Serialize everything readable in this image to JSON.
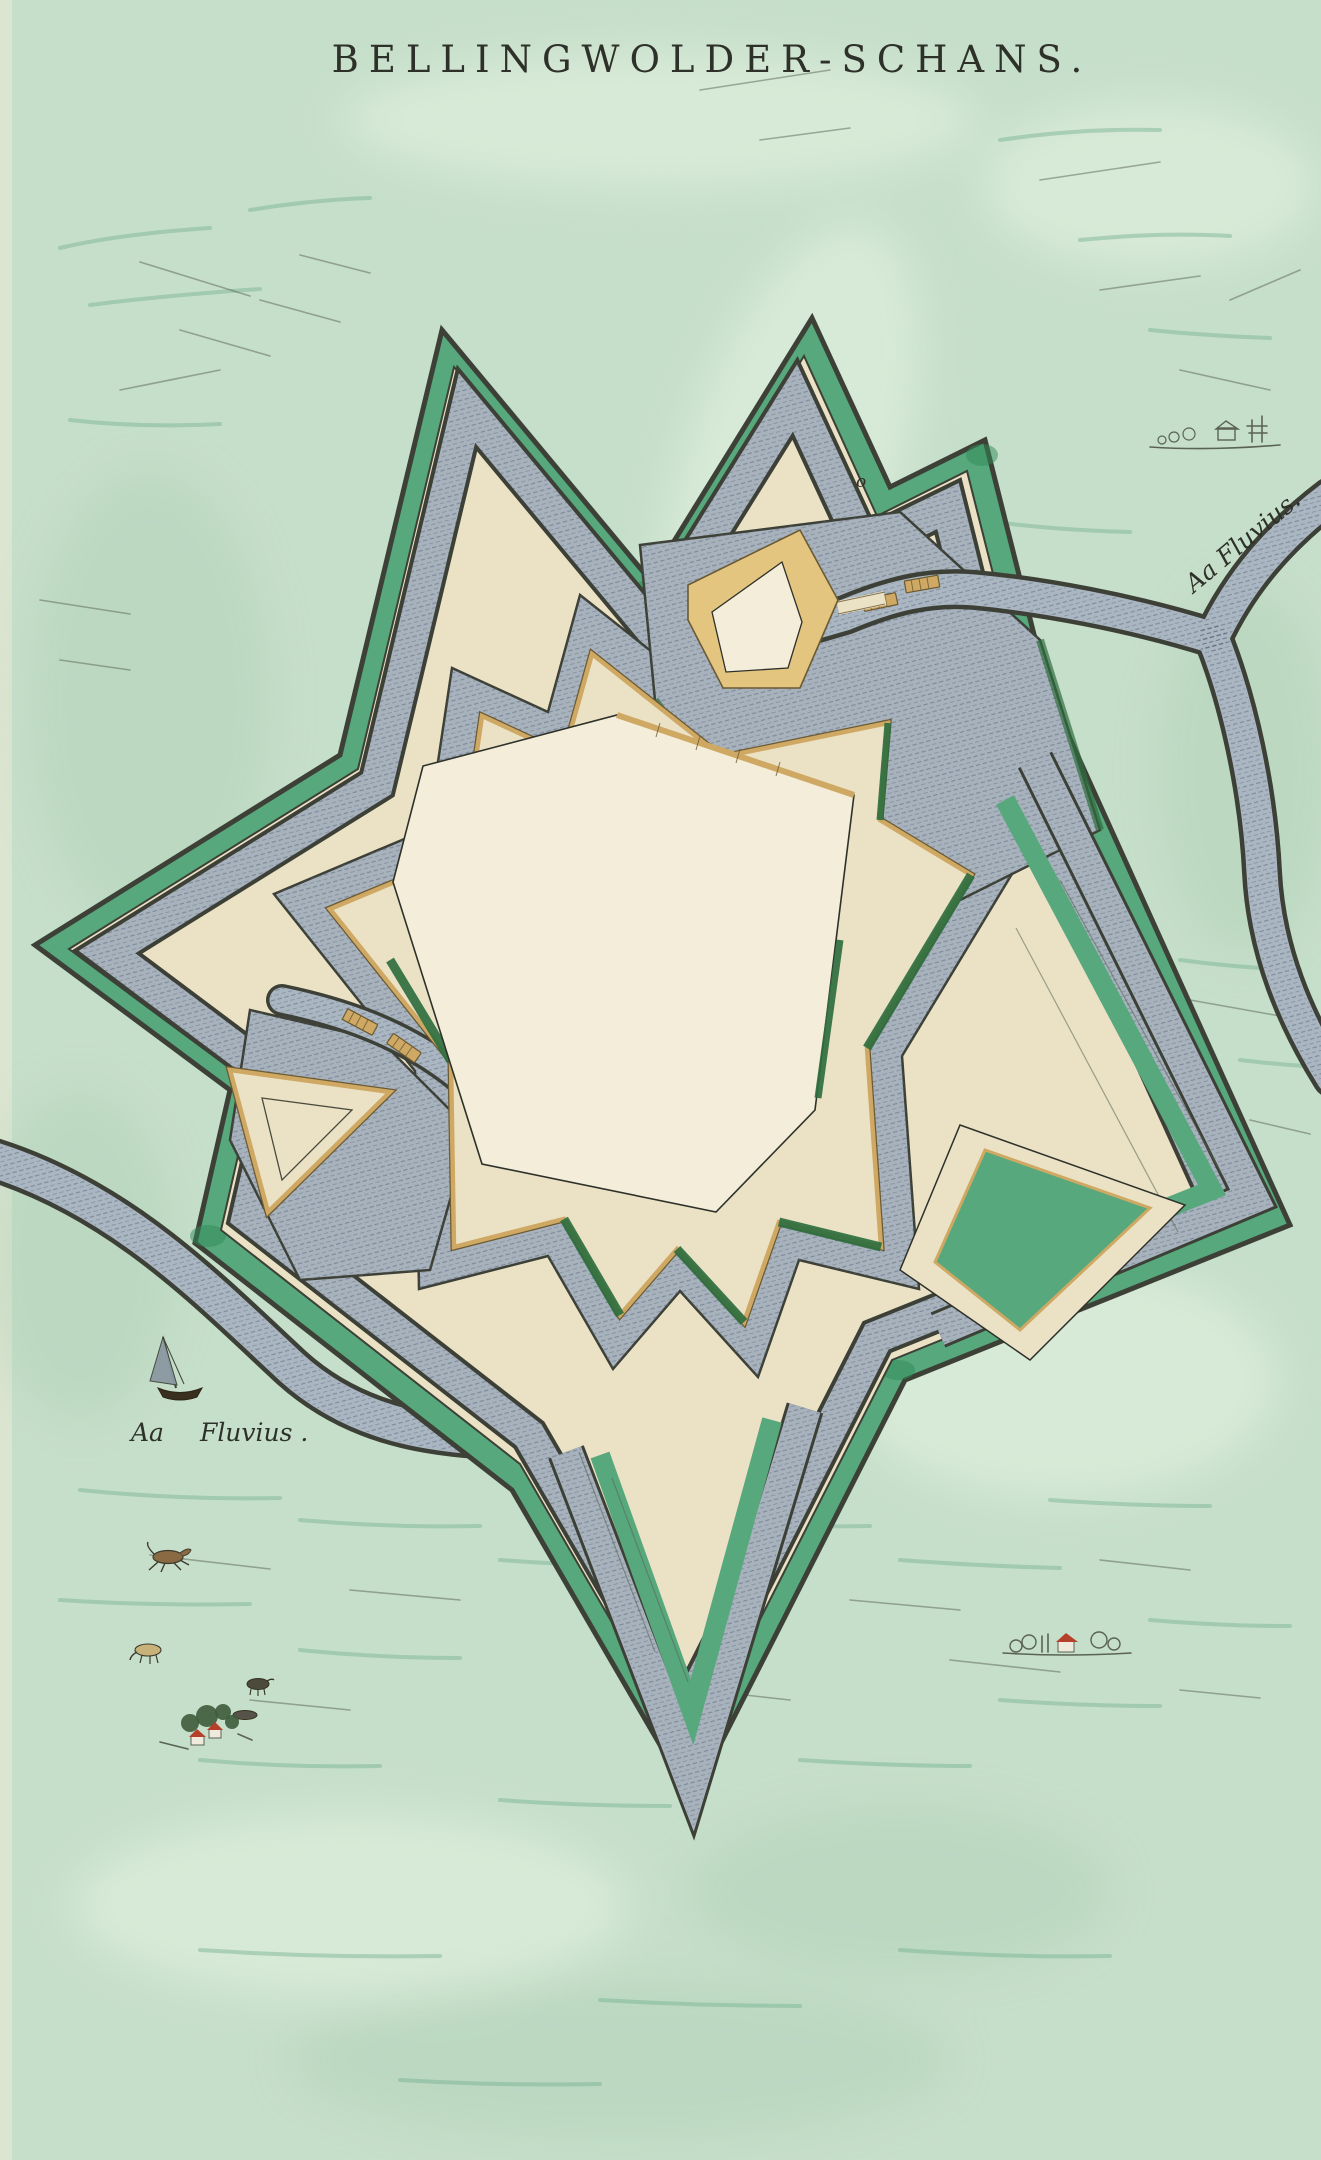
{
  "map": {
    "title": "BELLINGWOLDER-SCHANS.",
    "labels": {
      "river_northeast": "Aa Fluvius.",
      "river_southwest_word1": "Aa",
      "river_southwest_word2": "Fluvius .",
      "reference_mark": "o"
    },
    "subject": "star-shaped fortification plan with double moat, ravelins and the river Aa",
    "decorations": {
      "sailboat": "small sailboat on the river Aa",
      "horse": "galloping horse in the fields",
      "cattle": "grazing cattle",
      "hamlet": "farm hamlet with red-roofed houses and trees",
      "village": "distant village sketch with red-roofed house",
      "farmstead": "distant farmstead sketch with trees"
    }
  },
  "palette": {
    "bg": "#c6dfca",
    "wash-light": "#e6f2e2",
    "wash-dark": "#a4c9ad",
    "field-green": "#74b190",
    "sketch": "#5a6354",
    "ink": "#2e3129",
    "outline": "#3d4036",
    "green": "#57a87c",
    "green-dark": "#2f8a57",
    "slope": "#2f6e3f",
    "cream": "#ebe2c6",
    "cream-light": "#f3edda",
    "moat": "#a7b2bd",
    "moat-hatch": "#5d6a79",
    "river": "#aab6c1",
    "gold": "#cfa963",
    "gold-dark": "#6b5a33",
    "ochre": "#e4c57f",
    "roof": "#b5402c",
    "tree": "#3d5c3a"
  }
}
